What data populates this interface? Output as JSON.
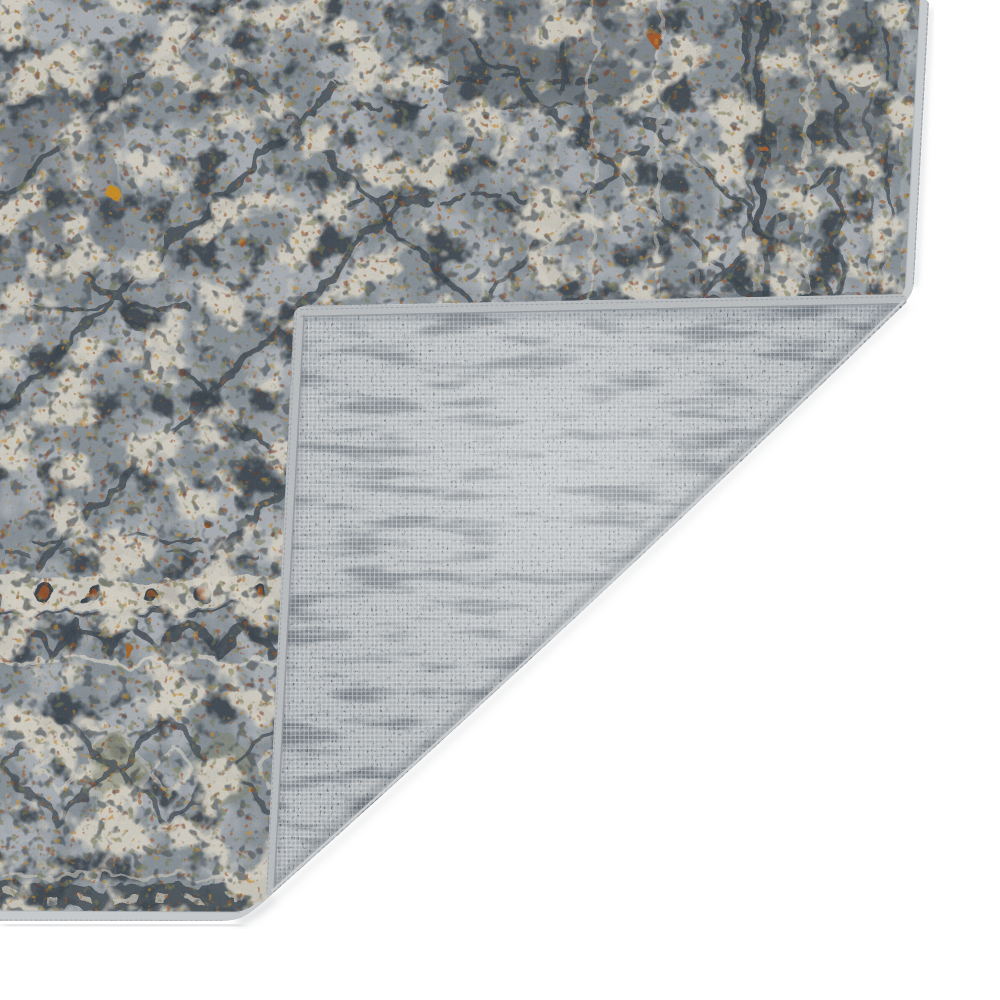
{
  "meta": {
    "title": "Area rug product photo",
    "description": "Product photograph of a distressed traditional-style area rug in slate blue, gray and cream with rust, gold and olive accents. The rug fills the upper-left of the frame; its bottom-right corner is folded over on a diagonal crease, revealing the light gray woven canvas backing with serged edge binding, all on a plain white background.",
    "subject": "rug-corner-folded-showing-backing"
  },
  "scene": {
    "background_color": "#ffffff",
    "rug_front": {
      "label": "distressed oriental pattern pile",
      "base_color": "#8f99a1",
      "light_color": "#b4bbc1",
      "cream_color": "#e8e3d5",
      "dark_color": "#39434d",
      "olive_color": "#7d8055",
      "gold_color": "#d1952f",
      "orange_color": "#a85a24",
      "rust_color": "#7c3a24",
      "motifs": "diagonal lattice lines, rosette guard band, chevron band, diamond medallion border, vertical side border stripes"
    },
    "rug_backing": {
      "label": "woven canvas backing",
      "base_color": "#c2c7ca",
      "streak_color": "#6e7880",
      "thread_color": "#f2f3f4"
    },
    "binding": {
      "label": "serged edge binding",
      "color": "#c7cacd",
      "seam_color": "#9aa1a6"
    },
    "shadow_color": "#7b8288"
  }
}
